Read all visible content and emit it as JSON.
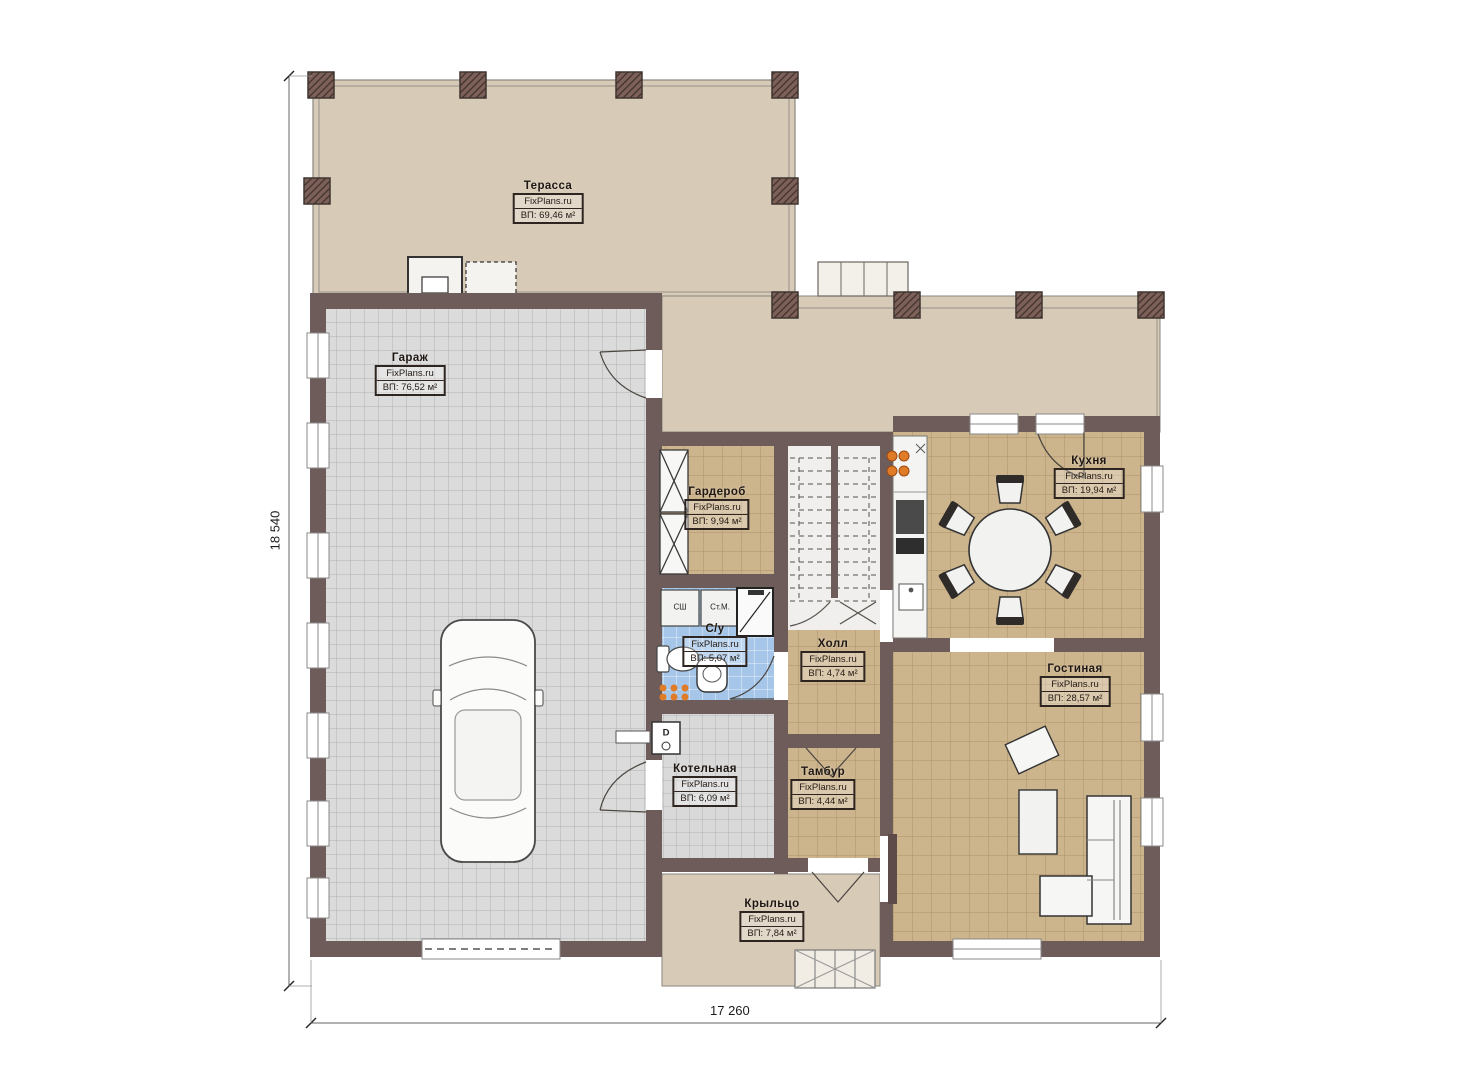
{
  "meta": {
    "type": "floor-plan",
    "language": "ru"
  },
  "dimensions": {
    "left": "18 540",
    "bottom": "17 260"
  },
  "rooms": [
    {
      "id": "terrace",
      "name": "Терасса",
      "brand": "FixPlans.ru",
      "area": "ВП: 69,46 м²"
    },
    {
      "id": "garage",
      "name": "Гараж",
      "brand": "FixPlans.ru",
      "area": "ВП: 76,52 м²"
    },
    {
      "id": "wardrobe",
      "name": "Гардероб",
      "brand": "FixPlans.ru",
      "area": "ВП: 9,94 м²"
    },
    {
      "id": "kitchen",
      "name": "Кухня",
      "brand": "FixPlans.ru",
      "area": "ВП: 19,94 м²"
    },
    {
      "id": "bathroom",
      "name": "С/у",
      "brand": "FixPlans.ru",
      "area": "ВП: 5,07 м²"
    },
    {
      "id": "hall",
      "name": "Холл",
      "brand": "FixPlans.ru",
      "area": "ВП: 4,74 м²"
    },
    {
      "id": "living",
      "name": "Гостиная",
      "brand": "FixPlans.ru",
      "area": "ВП: 28,57 м²"
    },
    {
      "id": "boiler",
      "name": "Котельная",
      "brand": "FixPlans.ru",
      "area": "ВП: 6,09 м²"
    },
    {
      "id": "vestibule",
      "name": "Тамбур",
      "brand": "FixPlans.ru",
      "area": "ВП: 4,44 м²"
    },
    {
      "id": "porch",
      "name": "Крыльцо",
      "brand": "FixPlans.ru",
      "area": "ВП: 7,84 м²"
    }
  ],
  "annotations": {
    "dryer": "СШ",
    "washer": "Ст.М.",
    "boiler_unit": "D"
  },
  "colors": {
    "wall": "#6d5c59",
    "terrace_floor": "#d7cab6",
    "tan_floor": "#ccb48d",
    "garage_floor": "#dbdbdb",
    "bath_floor": "#a6c6e9",
    "boiler_floor": "#d9d9d9",
    "burner_accent": "#e07b28"
  }
}
